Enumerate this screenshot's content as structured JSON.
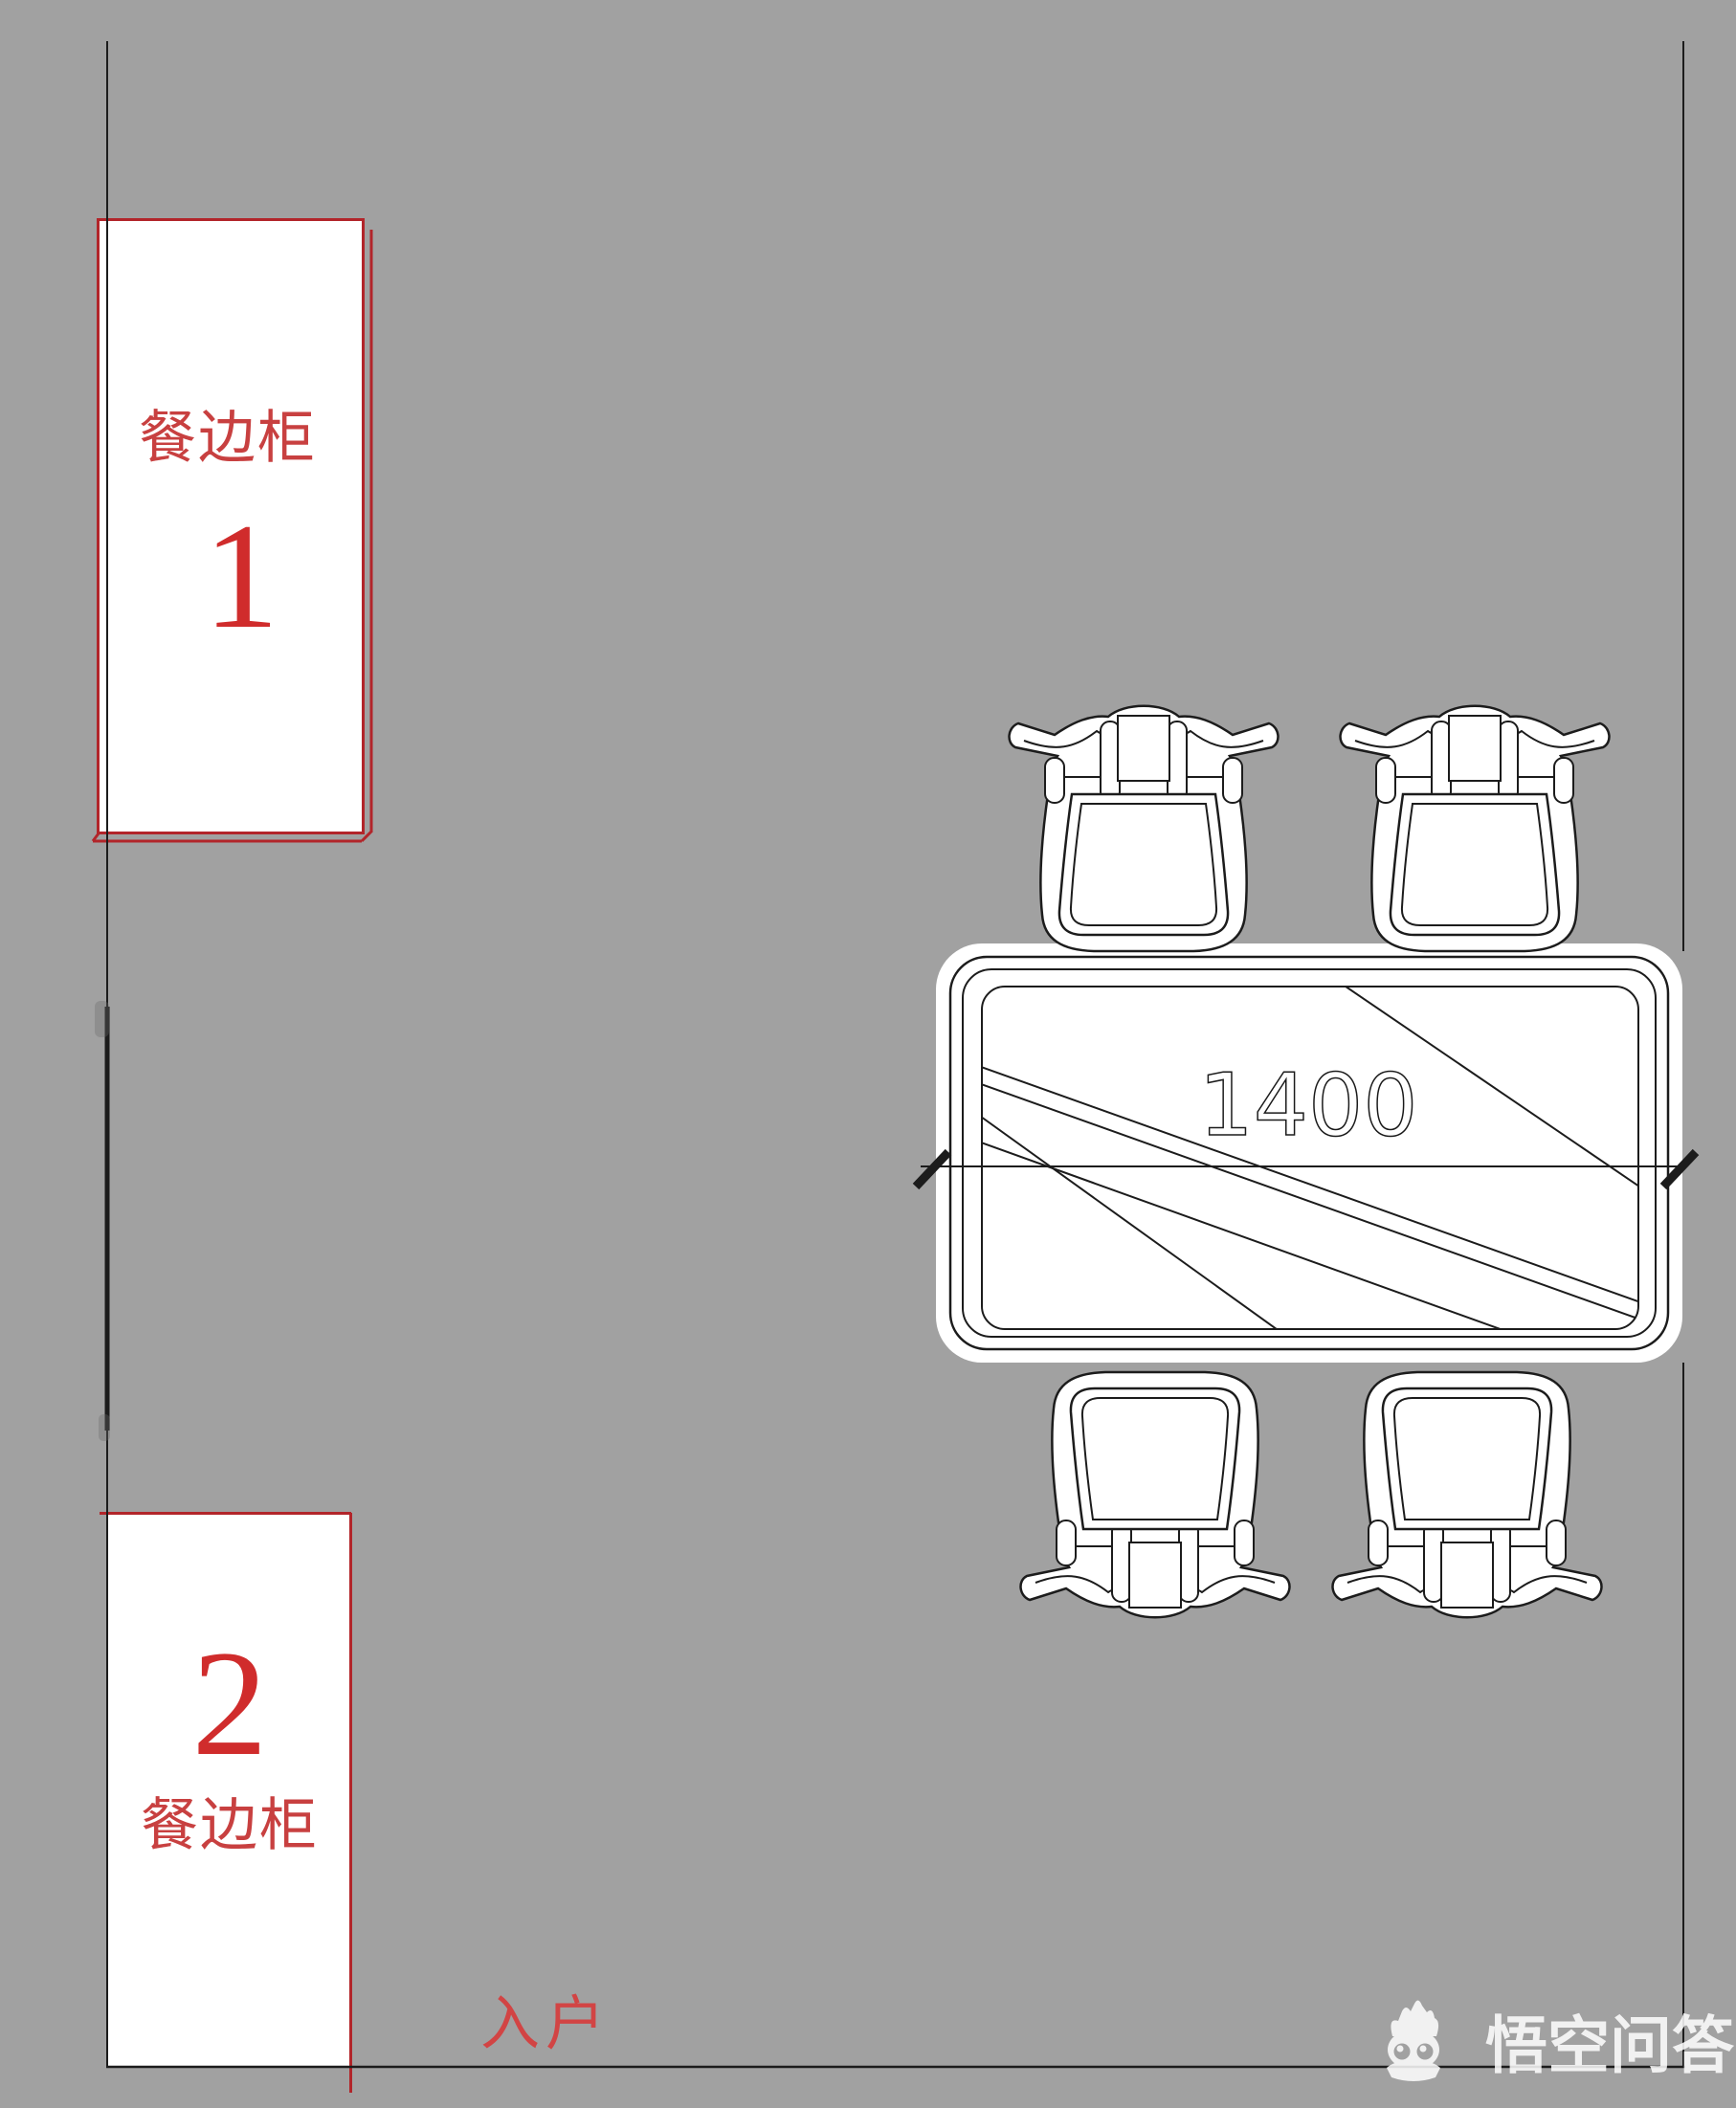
{
  "colors": {
    "background": "#a1a1a1",
    "wall_line": "#1c1c1c",
    "cabinet_border_red": "#b2252a",
    "label_red": "#c84040",
    "number_red": "#d02c2c",
    "entrance_red": "#d24444",
    "watermark_white": "#ffffff"
  },
  "cabinet1": {
    "label": "餐边柜",
    "number": "1"
  },
  "cabinet2": {
    "number": "2",
    "label": "餐边柜"
  },
  "dining_table": {
    "dimension_label": "1400",
    "chair_count": 4
  },
  "entrance_label": "入户",
  "watermark": {
    "text": "悟空问答"
  }
}
